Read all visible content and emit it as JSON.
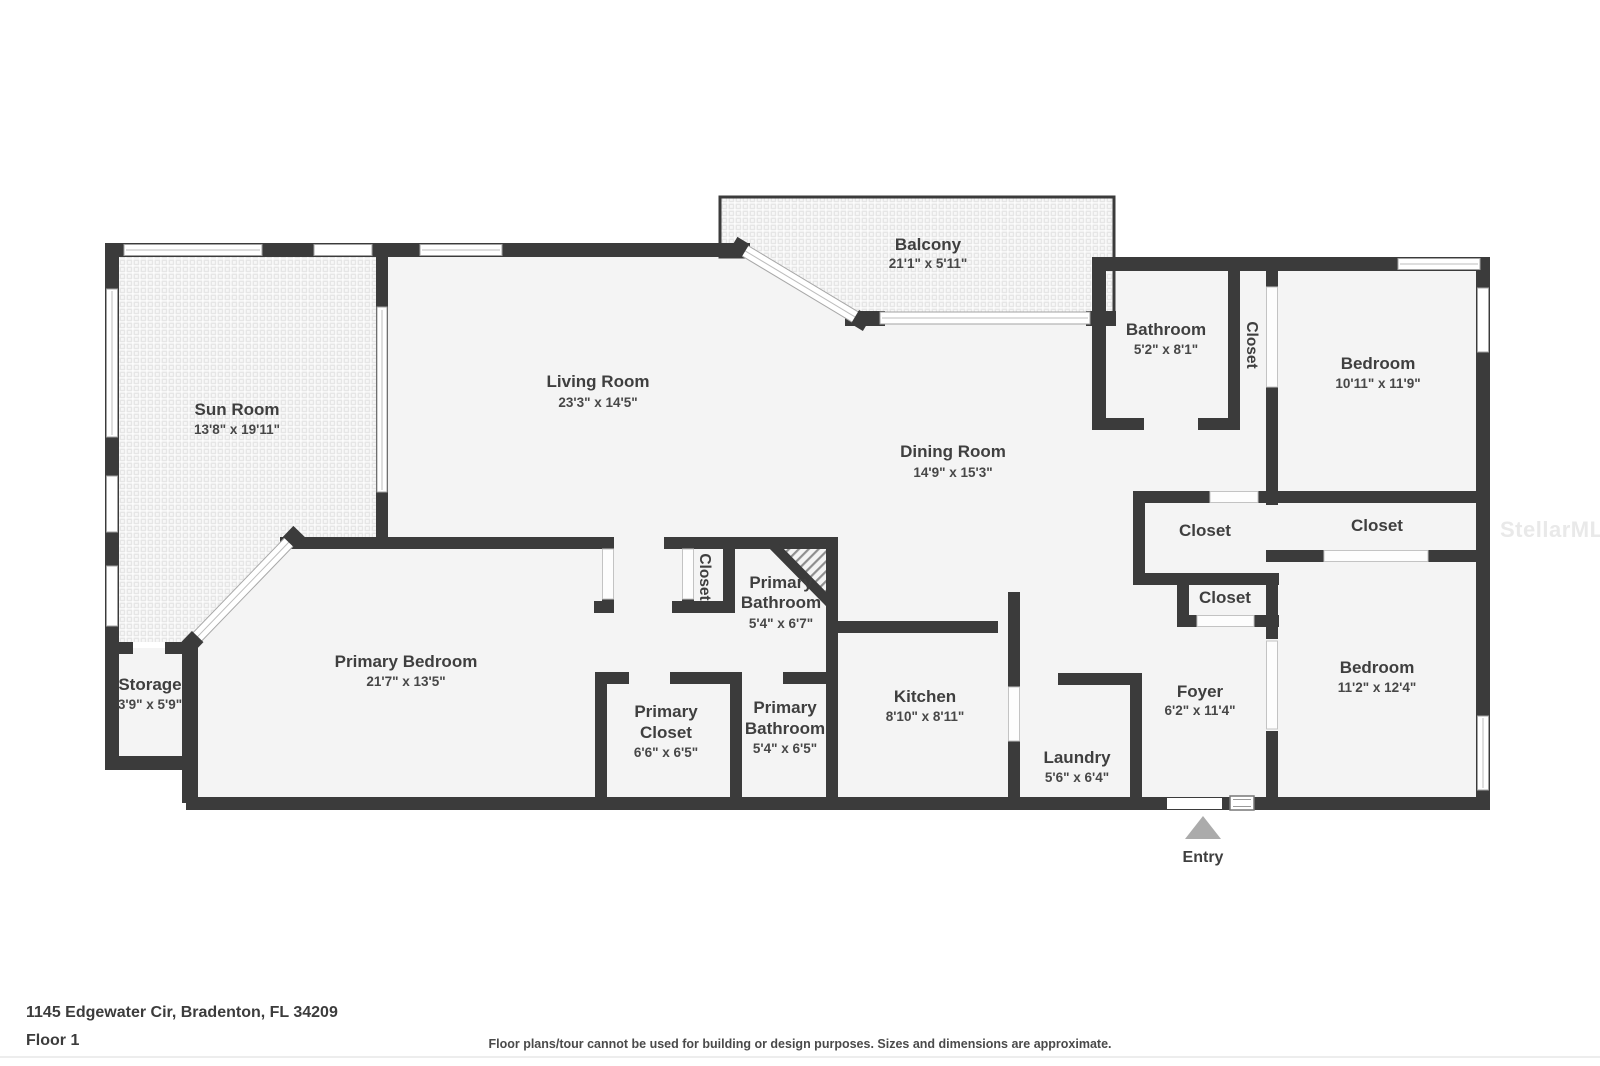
{
  "watermark": "StellarMLS",
  "footer": {
    "address": "1145 Edgewater Cir, Bradenton, FL 34209",
    "floor_label": "Floor 1",
    "disclaimer": "Floor plans/tour cannot be used for building or design purposes. Sizes and dimensions are approximate."
  },
  "entry": {
    "label": "Entry"
  },
  "colors": {
    "wall": "#3b3b3b",
    "floor": "#f4f4f4",
    "label_text": "#3f3f3f",
    "entry_arrow": "#ababab",
    "watermark": "#e9e9e9"
  },
  "rooms": {
    "balcony": {
      "name": "Balcony",
      "dims": "21'1\" x 5'11\""
    },
    "sun_room": {
      "name": "Sun Room",
      "dims": "13'8\" x 19'11\""
    },
    "living_room": {
      "name": "Living Room",
      "dims": "23'3\" x 14'5\""
    },
    "dining_room": {
      "name": "Dining Room",
      "dims": "14'9\" x 15'3\""
    },
    "bathroom": {
      "name": "Bathroom",
      "dims": "5'2\" x 8'1\""
    },
    "closet_hall_bath": {
      "name": "Closet"
    },
    "bedroom_top": {
      "name": "Bedroom",
      "dims": "10'11\" x 11'9\""
    },
    "closet_hall_left": {
      "name": "Closet"
    },
    "closet_bedroom_top": {
      "name": "Closet"
    },
    "closet_hall_small": {
      "name": "Closet"
    },
    "primary_bathroom_upper": {
      "line1": "Primary",
      "line2": "Bathroom",
      "dims": "5'4\" x 6'7\""
    },
    "closet_primary_hall": {
      "name": "Closet"
    },
    "primary_bedroom": {
      "name": "Primary Bedroom",
      "dims": "21'7\" x 13'5\""
    },
    "storage": {
      "name": "Storage",
      "dims": "3'9\" x 5'9\""
    },
    "primary_closet": {
      "line1": "Primary",
      "line2": "Closet",
      "dims": "6'6\" x 6'5\""
    },
    "primary_bathroom_lower": {
      "line1": "Primary",
      "line2": "Bathroom",
      "dims": "5'4\" x 6'5\""
    },
    "kitchen": {
      "name": "Kitchen",
      "dims": "8'10\" x 8'11\""
    },
    "laundry": {
      "name": "Laundry",
      "dims": "5'6\" x 6'4\""
    },
    "foyer": {
      "name": "Foyer",
      "dims": "6'2\" x 11'4\""
    },
    "bedroom_bottom": {
      "name": "Bedroom",
      "dims": "11'2\" x 12'4\""
    }
  }
}
